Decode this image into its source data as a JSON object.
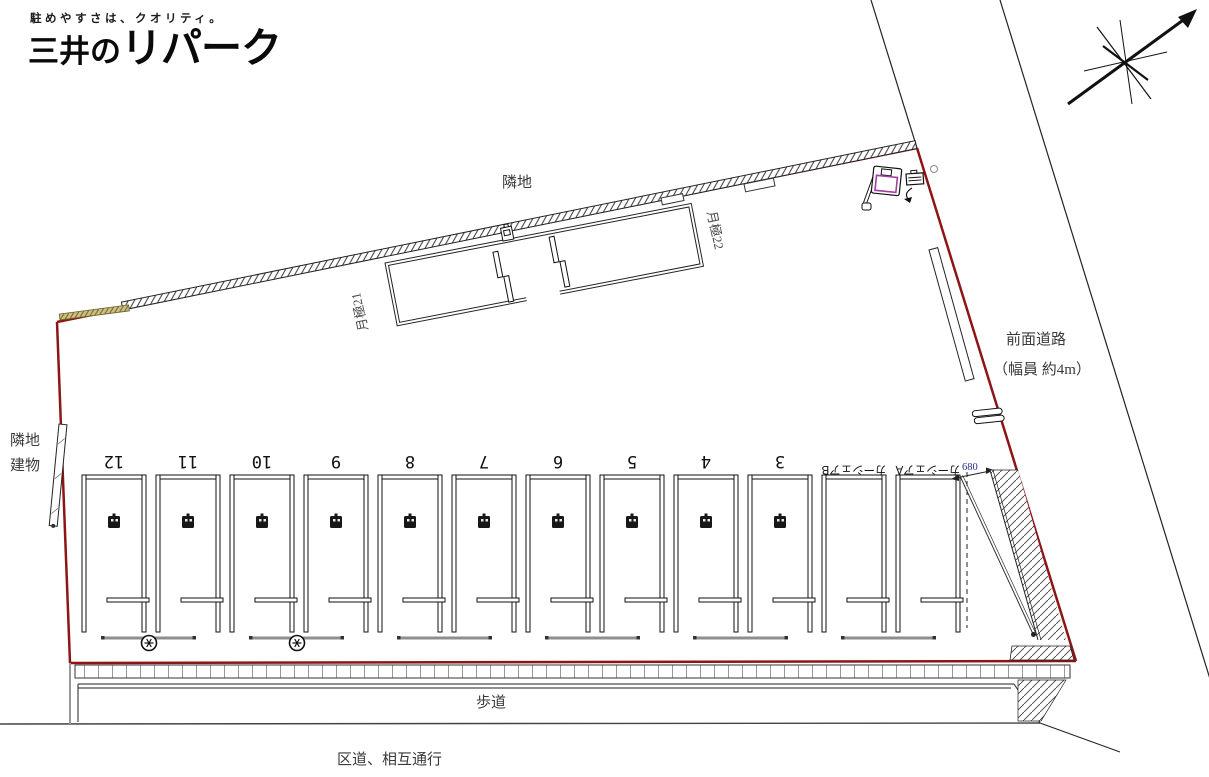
{
  "branding": {
    "tagline": "駐めやすさは、クオリティ。",
    "logo_prefix": "三井の",
    "logo_name": "リパーク"
  },
  "labels": {
    "adjacent_land_top": "隣地",
    "adjacent_left_line1": "隣地",
    "adjacent_left_line2": "建物",
    "front_road_line1": "前面道路",
    "front_road_line2": "（幅員 約4m）",
    "sidewalk": "歩道",
    "ward_road": "区道、相互通行",
    "monthly_left": "月極21",
    "monthly_right": "月極22",
    "dimension": "680"
  },
  "stalls": {
    "labels": [
      "12",
      "11",
      "10",
      "9",
      "8",
      "7",
      "6",
      "5",
      "4",
      "3",
      "カーシェアB",
      "カーシェアA"
    ]
  },
  "colors": {
    "boundary_red": "#8e1515",
    "dimension_blue": "#2b2b8f",
    "sign_magenta": "#a23fa2",
    "fence_khaki": "#cdbf85"
  }
}
